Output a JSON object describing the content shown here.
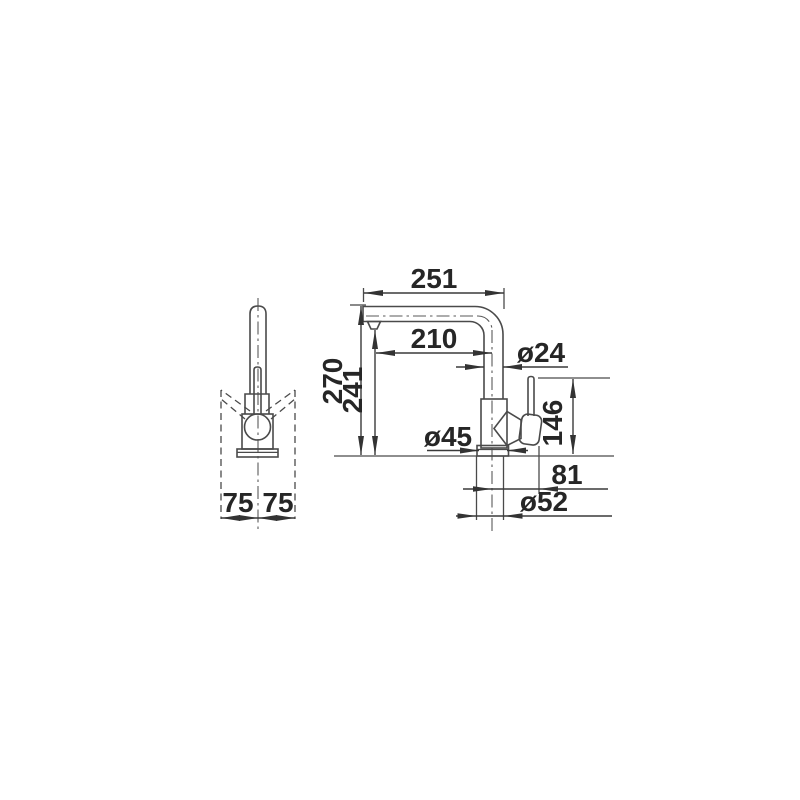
{
  "drawing": {
    "title": "faucet-dimension-drawing",
    "background": "#ffffff",
    "line_color": "#4a4a4a",
    "text_color": "#262626",
    "units": "mm",
    "front_view": {
      "base_left": "75",
      "base_right": "75"
    },
    "side_view": {
      "spout_overall_reach": "251",
      "spout_inner_reach": "210",
      "spout_tube_diameter": "ø24",
      "total_height": "270",
      "outlet_height": "241",
      "handle_top_height": "146",
      "body_diameter": "ø45",
      "handle_offset": "81",
      "base_diameter": "ø52"
    }
  }
}
